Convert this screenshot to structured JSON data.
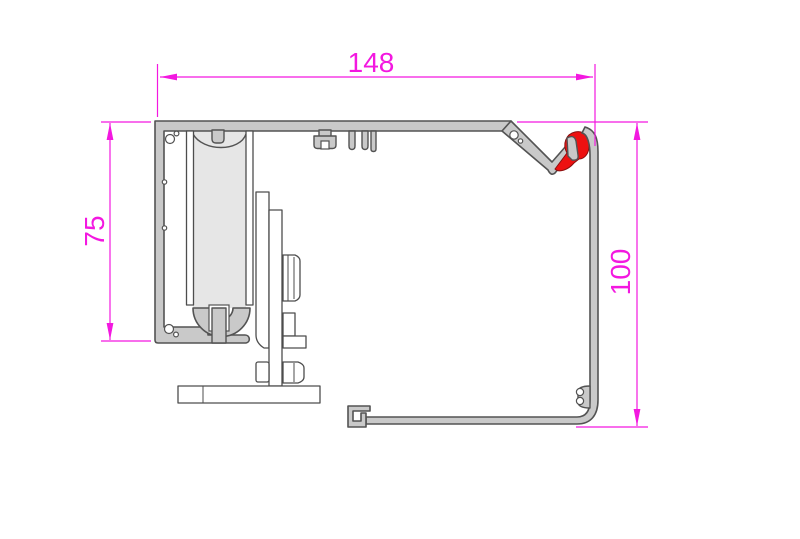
{
  "drawing": {
    "kind": "profile-cross-section",
    "dimensions": {
      "width": {
        "label": "148"
      },
      "height_left": {
        "label": "75"
      },
      "height_right": {
        "label": "100"
      }
    },
    "colors": {
      "dimension_magenta": "#f318e0",
      "profile_fill": "#c9c9c9",
      "profile_outline": "#535353",
      "roller_fill": "#e6e6e6",
      "seal_red": "#ed1111",
      "background": "#ffffff"
    }
  }
}
